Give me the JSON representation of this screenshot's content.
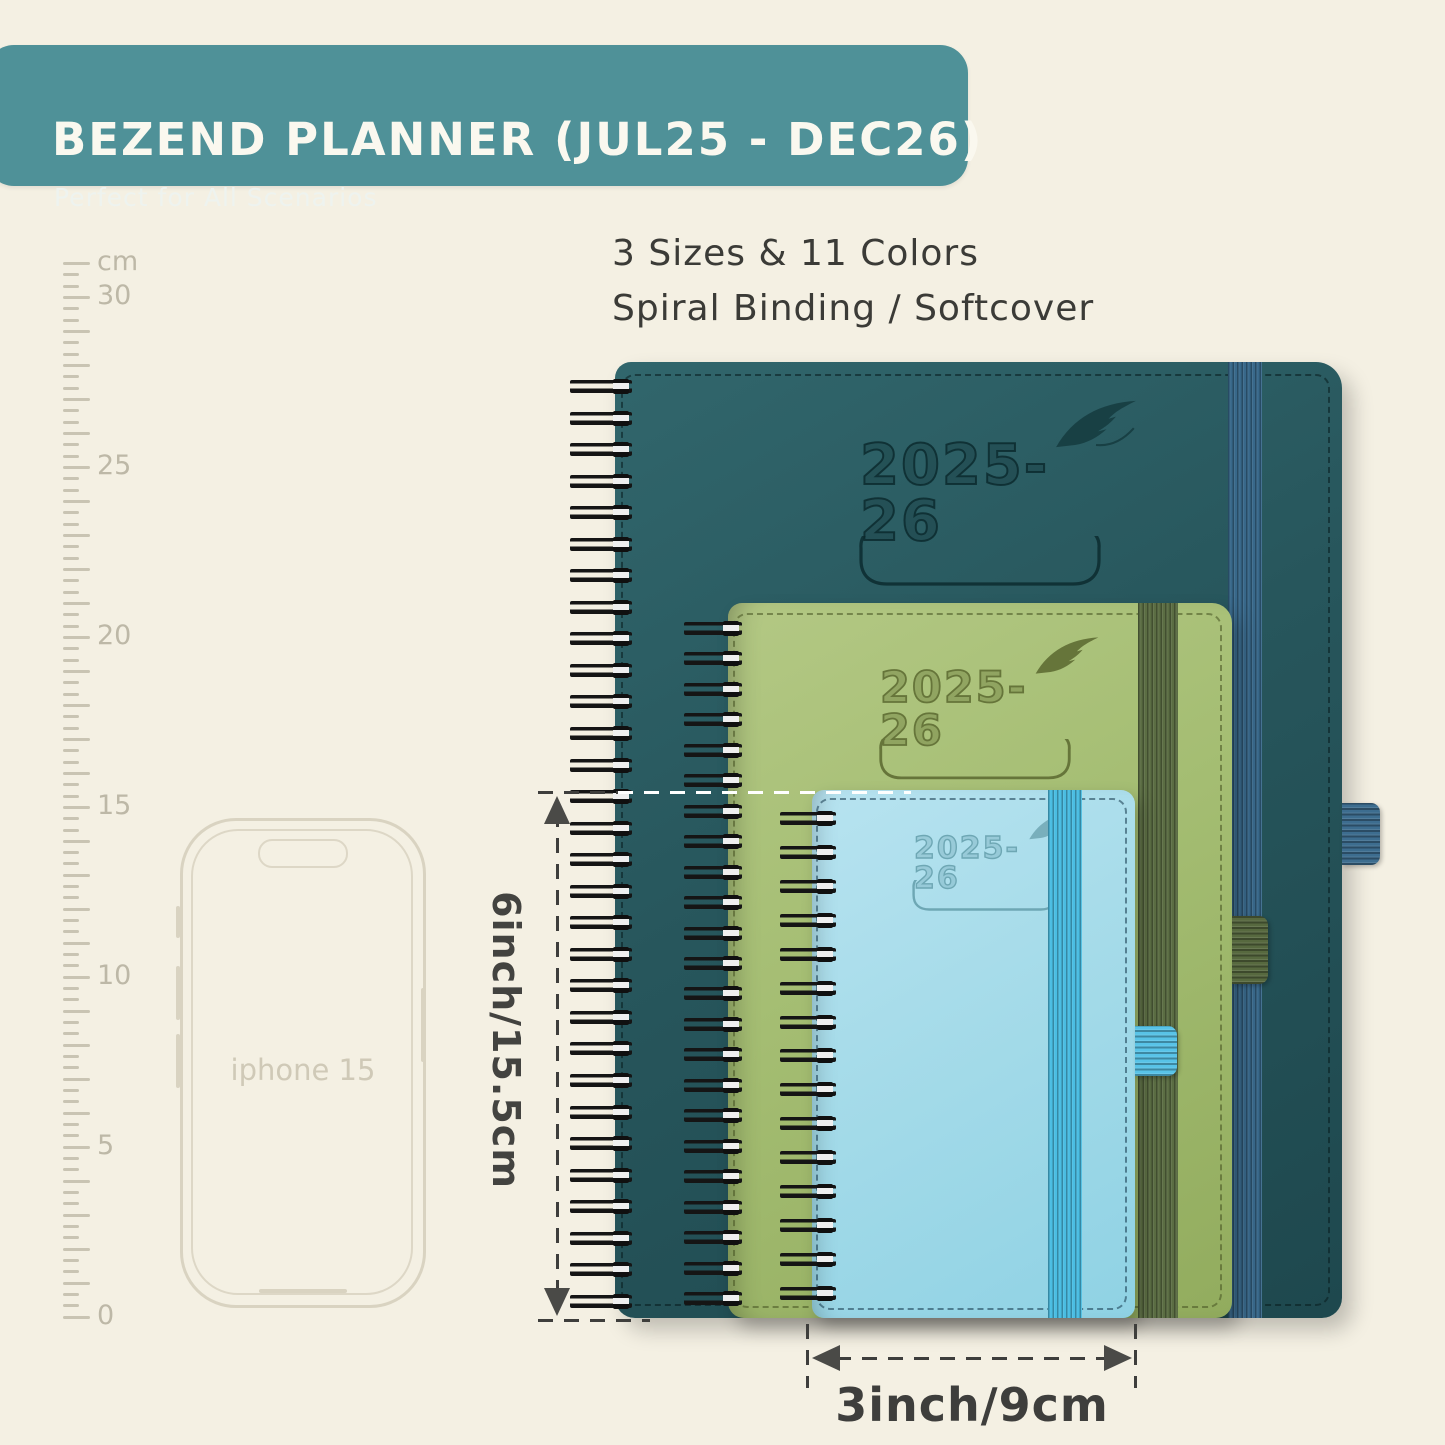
{
  "header": {
    "title": "BEZEND PLANNER (JUL25 - DEC26)",
    "subtitle": "Perfect for All Scenarios",
    "bg_color": "#4f9198",
    "text_color": "#faf8ef"
  },
  "info": {
    "line1": "3 Sizes & 11 Colors",
    "line2": "Spiral Binding / Softcover"
  },
  "ruler": {
    "unit_label": "cm",
    "labels": [
      "cm",
      "30",
      "25",
      "20",
      "15",
      "10",
      "5",
      "0"
    ],
    "tick_color": "#c9c4b3"
  },
  "phone": {
    "label": "iphone 15",
    "outline_color": "#d9d3c1"
  },
  "planners": {
    "large": {
      "year_label": "2025-26",
      "cover_color": "#27565c",
      "elastic_color": "#38688a",
      "binding": "spiral"
    },
    "medium": {
      "year_label": "2025-26",
      "cover_color": "#a4bd72",
      "elastic_color": "#5b6d43",
      "binding": "spiral"
    },
    "small": {
      "year_label": "2025-26",
      "cover_color": "#a5dbe9",
      "elastic_color": "#4abde2",
      "binding": "spiral"
    }
  },
  "dimensions": {
    "height_label": "6inch/15.5cm",
    "width_label": "3inch/9cm"
  },
  "background_color": "#f4f0e3"
}
